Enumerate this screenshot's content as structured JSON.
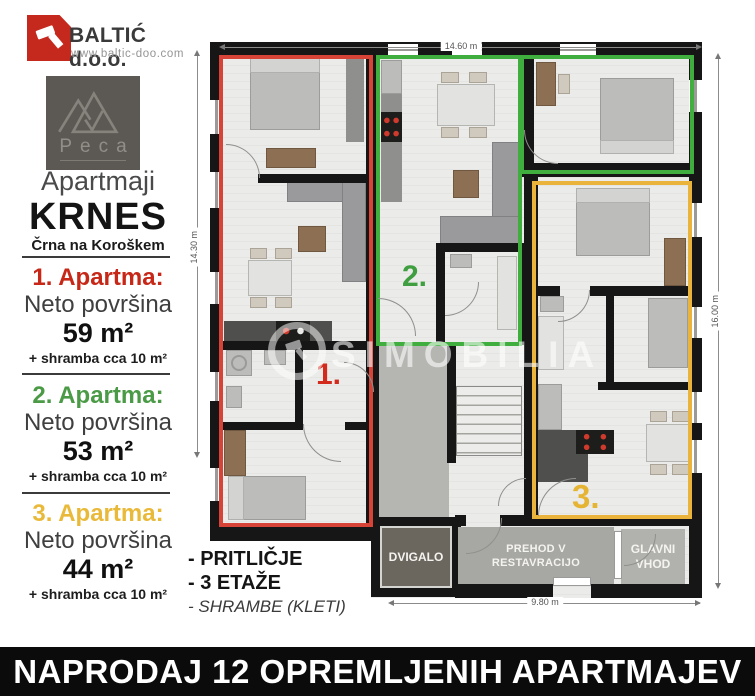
{
  "brand": {
    "name": "BALTIĆ d.o.o.",
    "url": "www.baltic-doo.com"
  },
  "peca": {
    "label": "Peca"
  },
  "header": {
    "line1": "Apartmaji",
    "line2": "KRNES",
    "line3": "Črna na Koroškem"
  },
  "apartments": [
    {
      "title": "1. Apartma:",
      "label": "Neto površina",
      "area": "59 m²",
      "extra": "+ shramba cca 10 m²",
      "color": "#c62717"
    },
    {
      "title": "2. Apartma:",
      "label": "Neto površina",
      "area": "53 m²",
      "extra": "+ shramba cca 10 m²",
      "color": "#4a9a46"
    },
    {
      "title": "3. Apartma:",
      "label": "Neto površina",
      "area": "44 m²",
      "extra": "+ shramba cca 10 m²",
      "color": "#e9b93a"
    }
  ],
  "notes": {
    "line1": "- PRITLIČJE",
    "line2": "- 3 ETAŽE",
    "line3": "- SHRAMBE (KLETI)"
  },
  "plan": {
    "dim_top": "14.60 m",
    "dim_left": "14.30 m",
    "dim_right": "16.00 m",
    "dim_bottom": "9.80 m",
    "label_1": "1.",
    "label_2": "2.",
    "label_3": "3.",
    "dvigalo": "DVIGALO",
    "prehod_line1": "PREHOD V",
    "prehod_line2": "RESTAVRACIJO",
    "glavni_line1": "GLAVNI",
    "glavni_line2": "VHOD"
  },
  "watermark": "SIMOBILIA",
  "banner": "NAPRODAJ 12 OPREMLJENIH APARTMAJEV",
  "colors": {
    "apartment1_outline": "#d84338",
    "apartment2_outline": "#3fae3f",
    "apartment3_outline": "#e9b33c",
    "brand_red": "#c5281c",
    "wall": "#161616",
    "corridor": "#b5b5b1"
  }
}
